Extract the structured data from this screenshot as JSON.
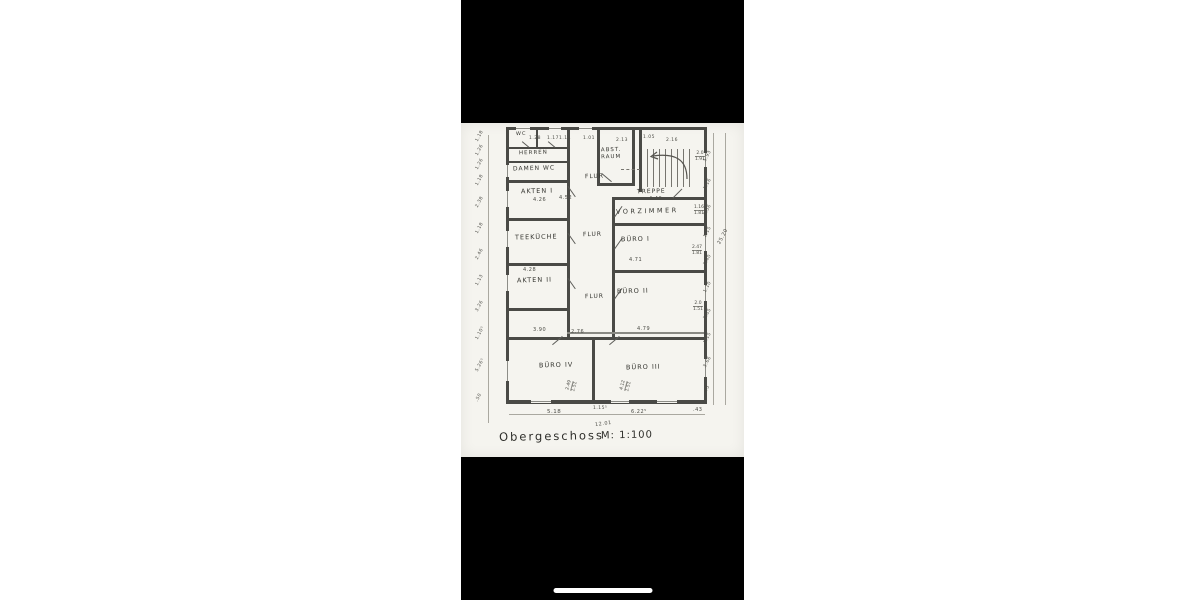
{
  "colors": {
    "letterbox": "#000000",
    "paper": "#f5f4ef",
    "ink": "#3a3a36"
  },
  "plan": {
    "caption": {
      "title": "Obergeschoss",
      "scale": "M: 1:100"
    },
    "rooms": {
      "wc": "WC",
      "herren": "HERREN",
      "damen_wc": "DAMEN WC",
      "akten1": "AKTEN I",
      "teekueche": "TEEKÜCHE",
      "akten2": "AKTEN II",
      "flur": "FLUR",
      "abstellraum": "ABST. RAUM",
      "treppe": "TREPPE",
      "vorzimmer": "VORZIMMER",
      "buero1": "BÜRO I",
      "buero2": "BÜRO II",
      "buero3": "BÜRO III",
      "buero4": "BÜRO IV"
    },
    "room_dims": {
      "akten1": "4.26",
      "akten2": "4.28",
      "flur_mid": "4.52",
      "vorzimmer": "4.46",
      "buero1": "4.71",
      "buero2": "4.79",
      "buero4_w": "3.90",
      "corridor_w": "2.76"
    },
    "bottom_dims": {
      "a": "5.18",
      "b": "1.15⁵",
      "c": "12.01",
      "d": "6.22⁵",
      "e": ".43"
    },
    "top_dims": [
      "1.28",
      "1.17",
      "1.14",
      "1.01",
      "2.13",
      "1.05",
      "2.16"
    ],
    "left_chain": [
      "1.18",
      "1.26",
      "1.26",
      "1.18",
      "2.38",
      "1.18",
      "2.46",
      "1.13",
      "3.26",
      "1.10⁵",
      "5.26⁵",
      ".50"
    ],
    "right_chain": [
      "5.93",
      "1.16",
      "2.36",
      "1.15",
      "3.40",
      "1.10",
      "3.65",
      "1.15",
      "3.66",
      ".43"
    ],
    "right_total": "25.20",
    "paired_dims": [
      {
        "a": "2.0",
        "b": "1.91"
      },
      {
        "a": "1.16",
        "b": "1.81"
      },
      {
        "a": "2.47",
        "b": "1.81"
      },
      {
        "a": "2.0",
        "b": "1.51"
      },
      {
        "a": "2.49",
        "b": "1.51"
      },
      {
        "a": "4.12",
        "b": "1.51"
      }
    ]
  }
}
